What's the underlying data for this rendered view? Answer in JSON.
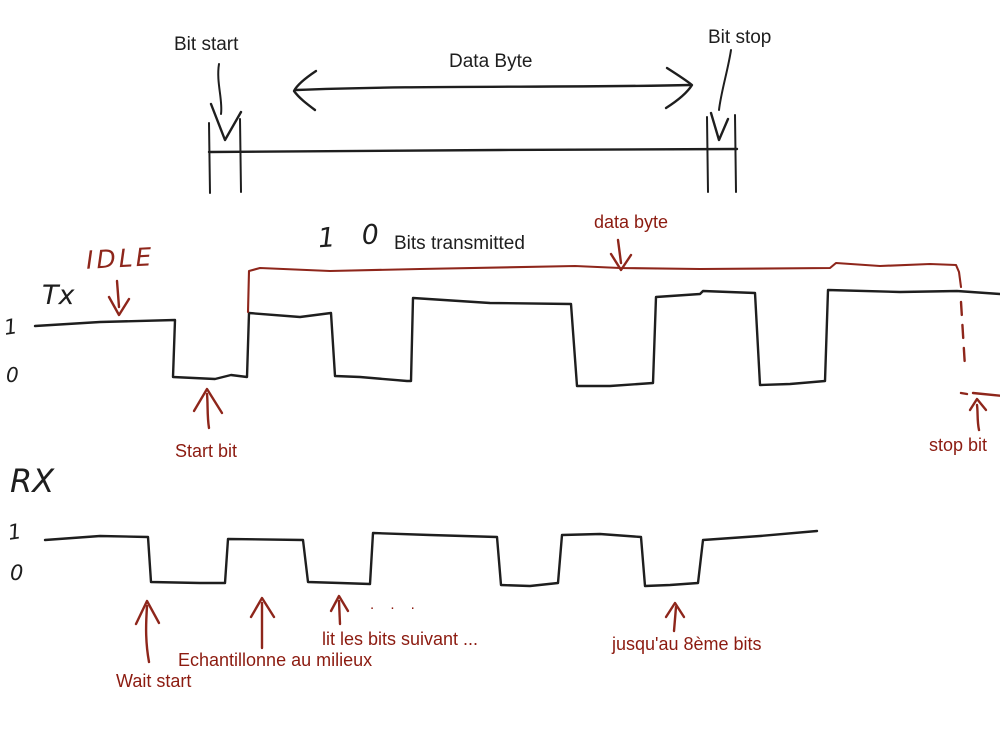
{
  "colors": {
    "background": "#ffffff",
    "ink_black": "#1e1e1e",
    "ink_red": "#8e261b",
    "text_red": "#8c1b10"
  },
  "top_diagram": {
    "bit_start_label": "Bit start",
    "data_byte_label": "Data Byte",
    "bit_stop_label": "Bit stop"
  },
  "tx_section": {
    "idle_label": "IDLE",
    "signal_label": "Tx",
    "level_high_label": "1",
    "level_low_label": "0",
    "bits_count_handwritten": "1 0",
    "bits_transmitted_label": "Bits transmitted",
    "data_byte_label": "data byte",
    "start_bit_label": "Start bit",
    "stop_bit_label": "stop bit",
    "bit_sequence_shown": [
      1,
      0,
      1,
      0,
      1,
      0,
      1,
      0,
      1
    ],
    "waveform_points": "35,326 100,322 175,320 173,377 215,379 231,375 247,377 249,313 300,317 331,313 335,376 360,377 407,381 411,381 413,298 490,303 571,304 577,386 610,386 653,383 656,297 700,294 703,291 755,293 760,385 790,384 825,381 828,290 900,292 957,291 1000,294",
    "data_byte_bracket_points": "248,312 249,271 260,268 330,271 420,269 575,266 620,268 700,269 830,268 836,263 880,266 930,264 956,265 959,272 961,287"
  },
  "rx_section": {
    "signal_label": "RX",
    "level_high_label": "1",
    "level_low_label": "0",
    "wait_start_label": "Wait start",
    "sample_middle_label": "Echantillonne au milieux",
    "read_next_bits_label": "lit les bits suivant ...",
    "until_8th_bit_label": "jusqu'au 8ème bits",
    "ellipsis_dots": ". . .",
    "bit_sequence_shown": [
      1,
      0,
      1,
      0,
      1,
      0,
      1,
      0,
      1
    ],
    "waveform_points": "45,540 100,536 148,537 151,582 200,583 225,583 228,539 303,540 308,582 340,583 370,584 373,533 430,535 497,537 501,585 530,586 558,583 562,535 600,534 641,537 645,586 670,585 698,583 703,540 760,536 817,531"
  }
}
